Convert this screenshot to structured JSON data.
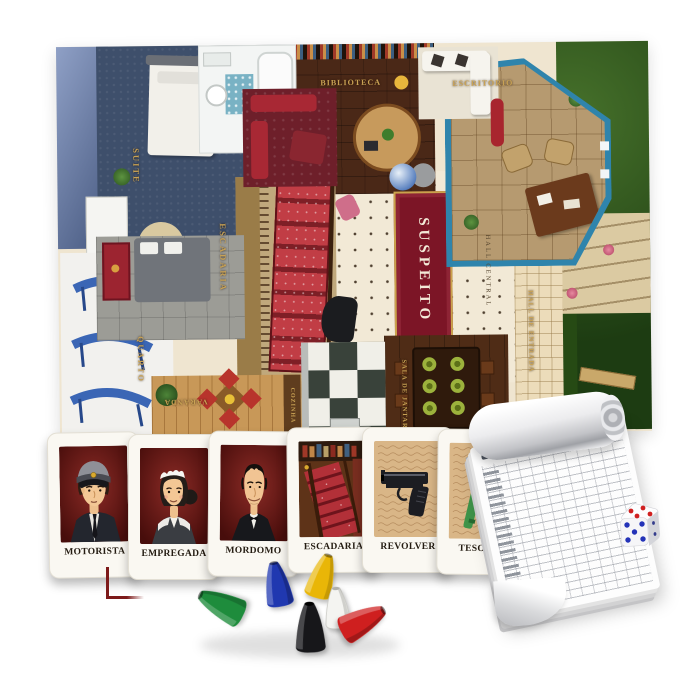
{
  "scene": {
    "description": "Detective mystery board game set: mansion game board, suspect and weapon cards, score pad, die and six cone pawns on white background",
    "background": "#ffffff"
  },
  "board": {
    "rooms": {
      "suite": "SUITE",
      "biblioteca": "BIBLIOTECA",
      "escritorio": "ESCRITORIO",
      "escadaria": "ESCADARIA",
      "quarto": "QUARTO",
      "varanda": "VARANDA",
      "cozinha": "COZINHA",
      "sala_de_jantar": "SALA DE JANTAR",
      "hall_central": "HALL CENTRAL",
      "hall_de_entrada": "HALL DE ENTRADA"
    },
    "center_label": "SUSPEITO",
    "label_color": "#c9a254",
    "suspect_rug_color": "#7c1526",
    "lawn_color": "#2d5a1e"
  },
  "cards": [
    {
      "label": "MOTORISTA",
      "type": "suspect"
    },
    {
      "label": "EMPREGADA",
      "type": "suspect"
    },
    {
      "label": "MORDOMO",
      "type": "suspect"
    },
    {
      "label": "ESCADARIA",
      "type": "room"
    },
    {
      "label": "REVOLVER",
      "type": "weapon"
    },
    {
      "label": "TESOURA",
      "type": "weapon"
    }
  ],
  "pawns": [
    {
      "name": "green",
      "hex": "#1e8c3c",
      "pose": "lying"
    },
    {
      "name": "blue",
      "hex": "#2038b0",
      "pose": "standing"
    },
    {
      "name": "yellow",
      "hex": "#e9b607",
      "pose": "leaning"
    },
    {
      "name": "black",
      "hex": "#17171a",
      "pose": "standing"
    },
    {
      "name": "white",
      "hex": "#f4f4f1",
      "pose": "standing"
    },
    {
      "name": "red",
      "hex": "#cf1f1f",
      "pose": "lying"
    }
  ],
  "die": {
    "body_color": "#ffffff",
    "top_face_pips": 4,
    "top_pip_color": "#d02020",
    "front_face_pips": 5,
    "front_pip_color": "#2433b8",
    "side_face_pips": 2
  },
  "notepad": {
    "kind": "detective-score-pad",
    "paper_color": "#ffffff"
  },
  "marker": {
    "shape": "corner-bracket",
    "color": "#7d1a1a"
  }
}
